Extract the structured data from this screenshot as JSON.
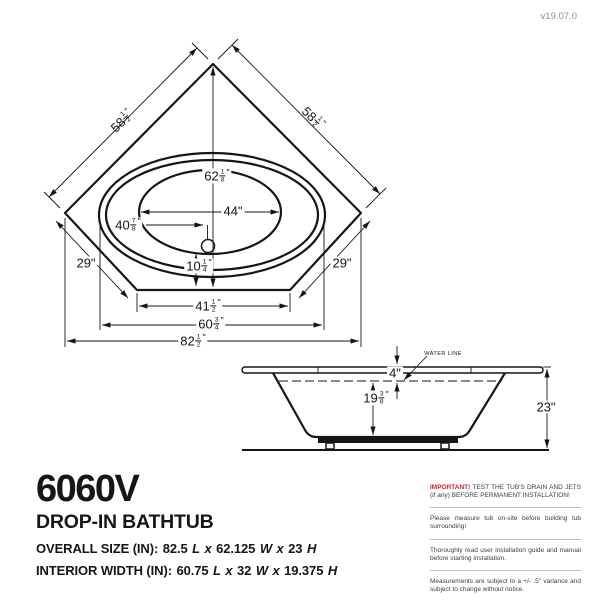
{
  "page": {
    "version": "v19.07.0"
  },
  "colors": {
    "red": "#d22027",
    "line": "#161616",
    "muted": "#8f8f8f"
  },
  "top_view": {
    "dim_edge_top_left": {
      "whole": "58",
      "num": "1",
      "den": "2",
      "unit": "\""
    },
    "dim_edge_top_right": {
      "whole": "58",
      "num": "1",
      "den": "2",
      "unit": "\""
    },
    "dim_length": {
      "whole": "62",
      "num": "1",
      "den": "8",
      "unit": "\""
    },
    "dim_interior_width": "44\"",
    "dim_drain_offset": {
      "whole": "40",
      "num": "7",
      "den": "8",
      "unit": "\""
    },
    "dim_drain_to_front": {
      "whole": "10",
      "num": "1",
      "den": "4",
      "unit": "\""
    },
    "dim_corner_left": "29\"",
    "dim_corner_right": "29\"",
    "dim_front_edge": {
      "whole": "41",
      "num": "1",
      "den": "2",
      "unit": "\""
    },
    "dim_rim_width": {
      "whole": "60",
      "num": "3",
      "den": "4",
      "unit": "\""
    },
    "dim_overall_width": {
      "whole": "82",
      "num": "1",
      "den": "2",
      "unit": "\""
    }
  },
  "side_view": {
    "water_line_label": "WATER LINE",
    "dim_rim_to_water": "4\"",
    "dim_water_depth": {
      "whole": "19",
      "num": "3",
      "den": "8",
      "unit": "\""
    },
    "dim_overall_height": "23\""
  },
  "info": {
    "model": "6060V",
    "product_type": "DROP-IN BATHTUB",
    "overall": {
      "label": "OVERALL SIZE (IN):",
      "length": "82.5",
      "l": "L",
      "x1": "x",
      "width": "62.125",
      "w": "W",
      "x2": "x",
      "height": "23",
      "h": "H"
    },
    "interior": {
      "label": "INTERIOR WIDTH (IN):",
      "length": "60.75",
      "l": "L",
      "x1": "x",
      "width": "32",
      "w": "W",
      "x2": "x",
      "height": "19.375",
      "h": "H"
    }
  },
  "notices": [
    {
      "highlight": "IMPORTANT!",
      "text": " TEST THE TUB'S DRAIN AND JETS (if any) BEFORE PERMANENT INSTALLATION!"
    },
    {
      "highlight": "",
      "text": "Please measure tub on-site before building tub surrounding!"
    },
    {
      "highlight": "",
      "text": "Thoroughly read user installation guide and manual before starting installation."
    },
    {
      "highlight": "",
      "text": "Measurements are subject to a +/- .5\" variance and subject to change without notice."
    }
  ]
}
